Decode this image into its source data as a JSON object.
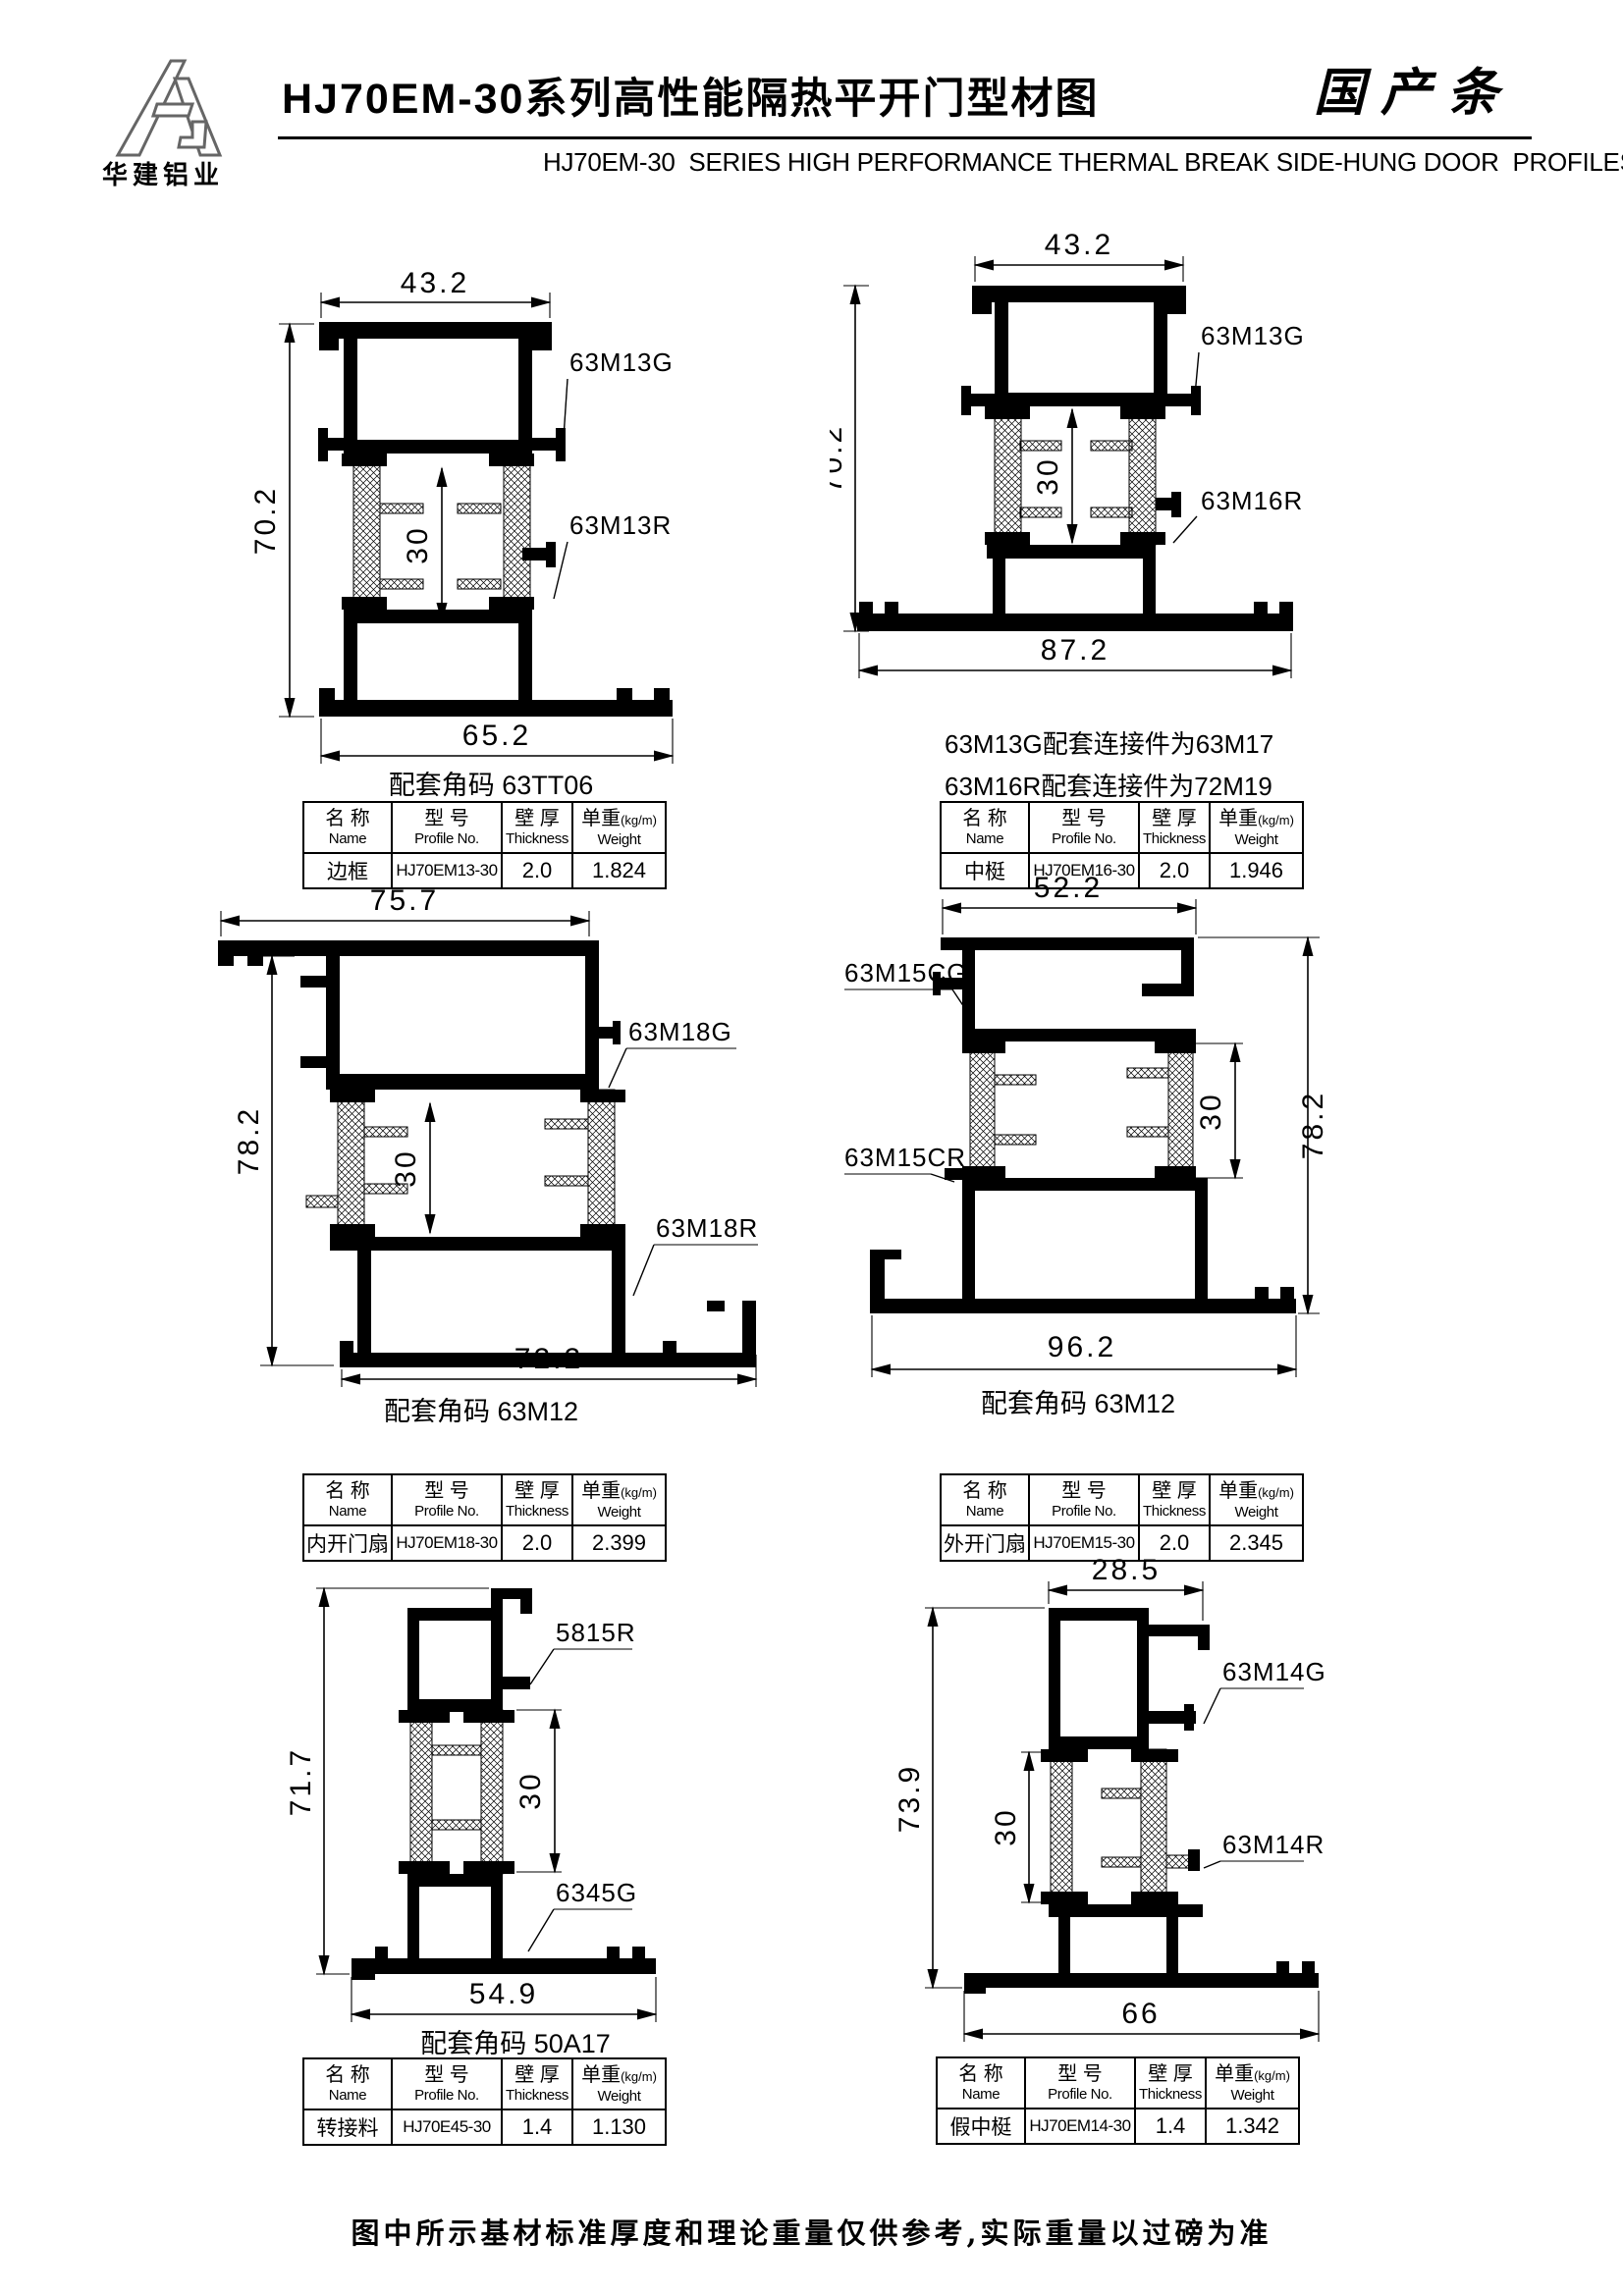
{
  "header": {
    "logo_text": "华建铝业",
    "title": "HJ70EM-30系列高性能隔热平开门型材图",
    "stamp": "国产条",
    "subtitle": "HJ70EM-30  SERIES HIGH PERFORMANCE THERMAL BREAK SIDE-HUNG DOOR  PROFILES"
  },
  "th": {
    "name_cn": "名 称",
    "name_en": "Name",
    "model_cn": "型 号",
    "model_en": "Profile No.",
    "thk_cn": "壁 厚",
    "thk_en": "Thickness",
    "wt_cn": "单重",
    "wt_unit": "(kg/m)",
    "wt_en": "Weight"
  },
  "drawings": [
    {
      "dim_top": "43.2",
      "dim_side": "70.2",
      "dim_inner": "30",
      "dim_bottom": "65.2",
      "label_a": "63M13G",
      "label_b": "63M13R",
      "caption": "配套角码 63TT06",
      "table": {
        "name": "边框",
        "model": "HJ70EM13-30",
        "thickness": "2.0",
        "weight": "1.824"
      }
    },
    {
      "dim_top": "43.2",
      "dim_side": "70.2",
      "dim_inner": "30",
      "dim_bottom": "87.2",
      "label_a": "63M13G",
      "label_b": "63M16R",
      "caption_a": "63M13G配套连接件为63M17",
      "caption_b": "63M16R配套连接件为72M19",
      "table": {
        "name": "中梃",
        "model": "HJ70EM16-30",
        "thickness": "2.0",
        "weight": "1.946"
      }
    },
    {
      "dim_top": "75.7",
      "dim_side": "78.2",
      "dim_inner": "30",
      "dim_bottom": "72.2",
      "label_a": "63M18G",
      "label_b": "63M18R",
      "caption": "配套角码 63M12",
      "table": {
        "name": "内开门扇",
        "model": "HJ70EM18-30",
        "thickness": "2.0",
        "weight": "2.399"
      }
    },
    {
      "dim_top": "52.2",
      "dim_side": "78.2",
      "dim_inner": "30",
      "dim_bottom": "96.2",
      "label_a": "63M15CG",
      "label_b": "63M15CR",
      "caption": "配套角码 63M12",
      "table": {
        "name": "外开门扇",
        "model": "HJ70EM15-30",
        "thickness": "2.0",
        "weight": "2.345"
      }
    },
    {
      "dim_side": "71.7",
      "dim_inner": "30",
      "dim_bottom": "54.9",
      "label_a": "5815R",
      "label_b": "6345G",
      "caption": "配套角码 50A17",
      "table": {
        "name": "转接料",
        "model": "HJ70E45-30",
        "thickness": "1.4",
        "weight": "1.130"
      }
    },
    {
      "dim_top": "28.5",
      "dim_side": "73.9",
      "dim_inner": "30",
      "dim_bottom": "66",
      "label_a": "63M14G",
      "label_b": "63M14R",
      "table": {
        "name": "假中梃",
        "model": "HJ70EM14-30",
        "thickness": "1.4",
        "weight": "1.342"
      }
    }
  ],
  "footer": {
    "note": "图中所示基材标准厚度和理论重量仅供参考,实际重量以过磅为准"
  }
}
